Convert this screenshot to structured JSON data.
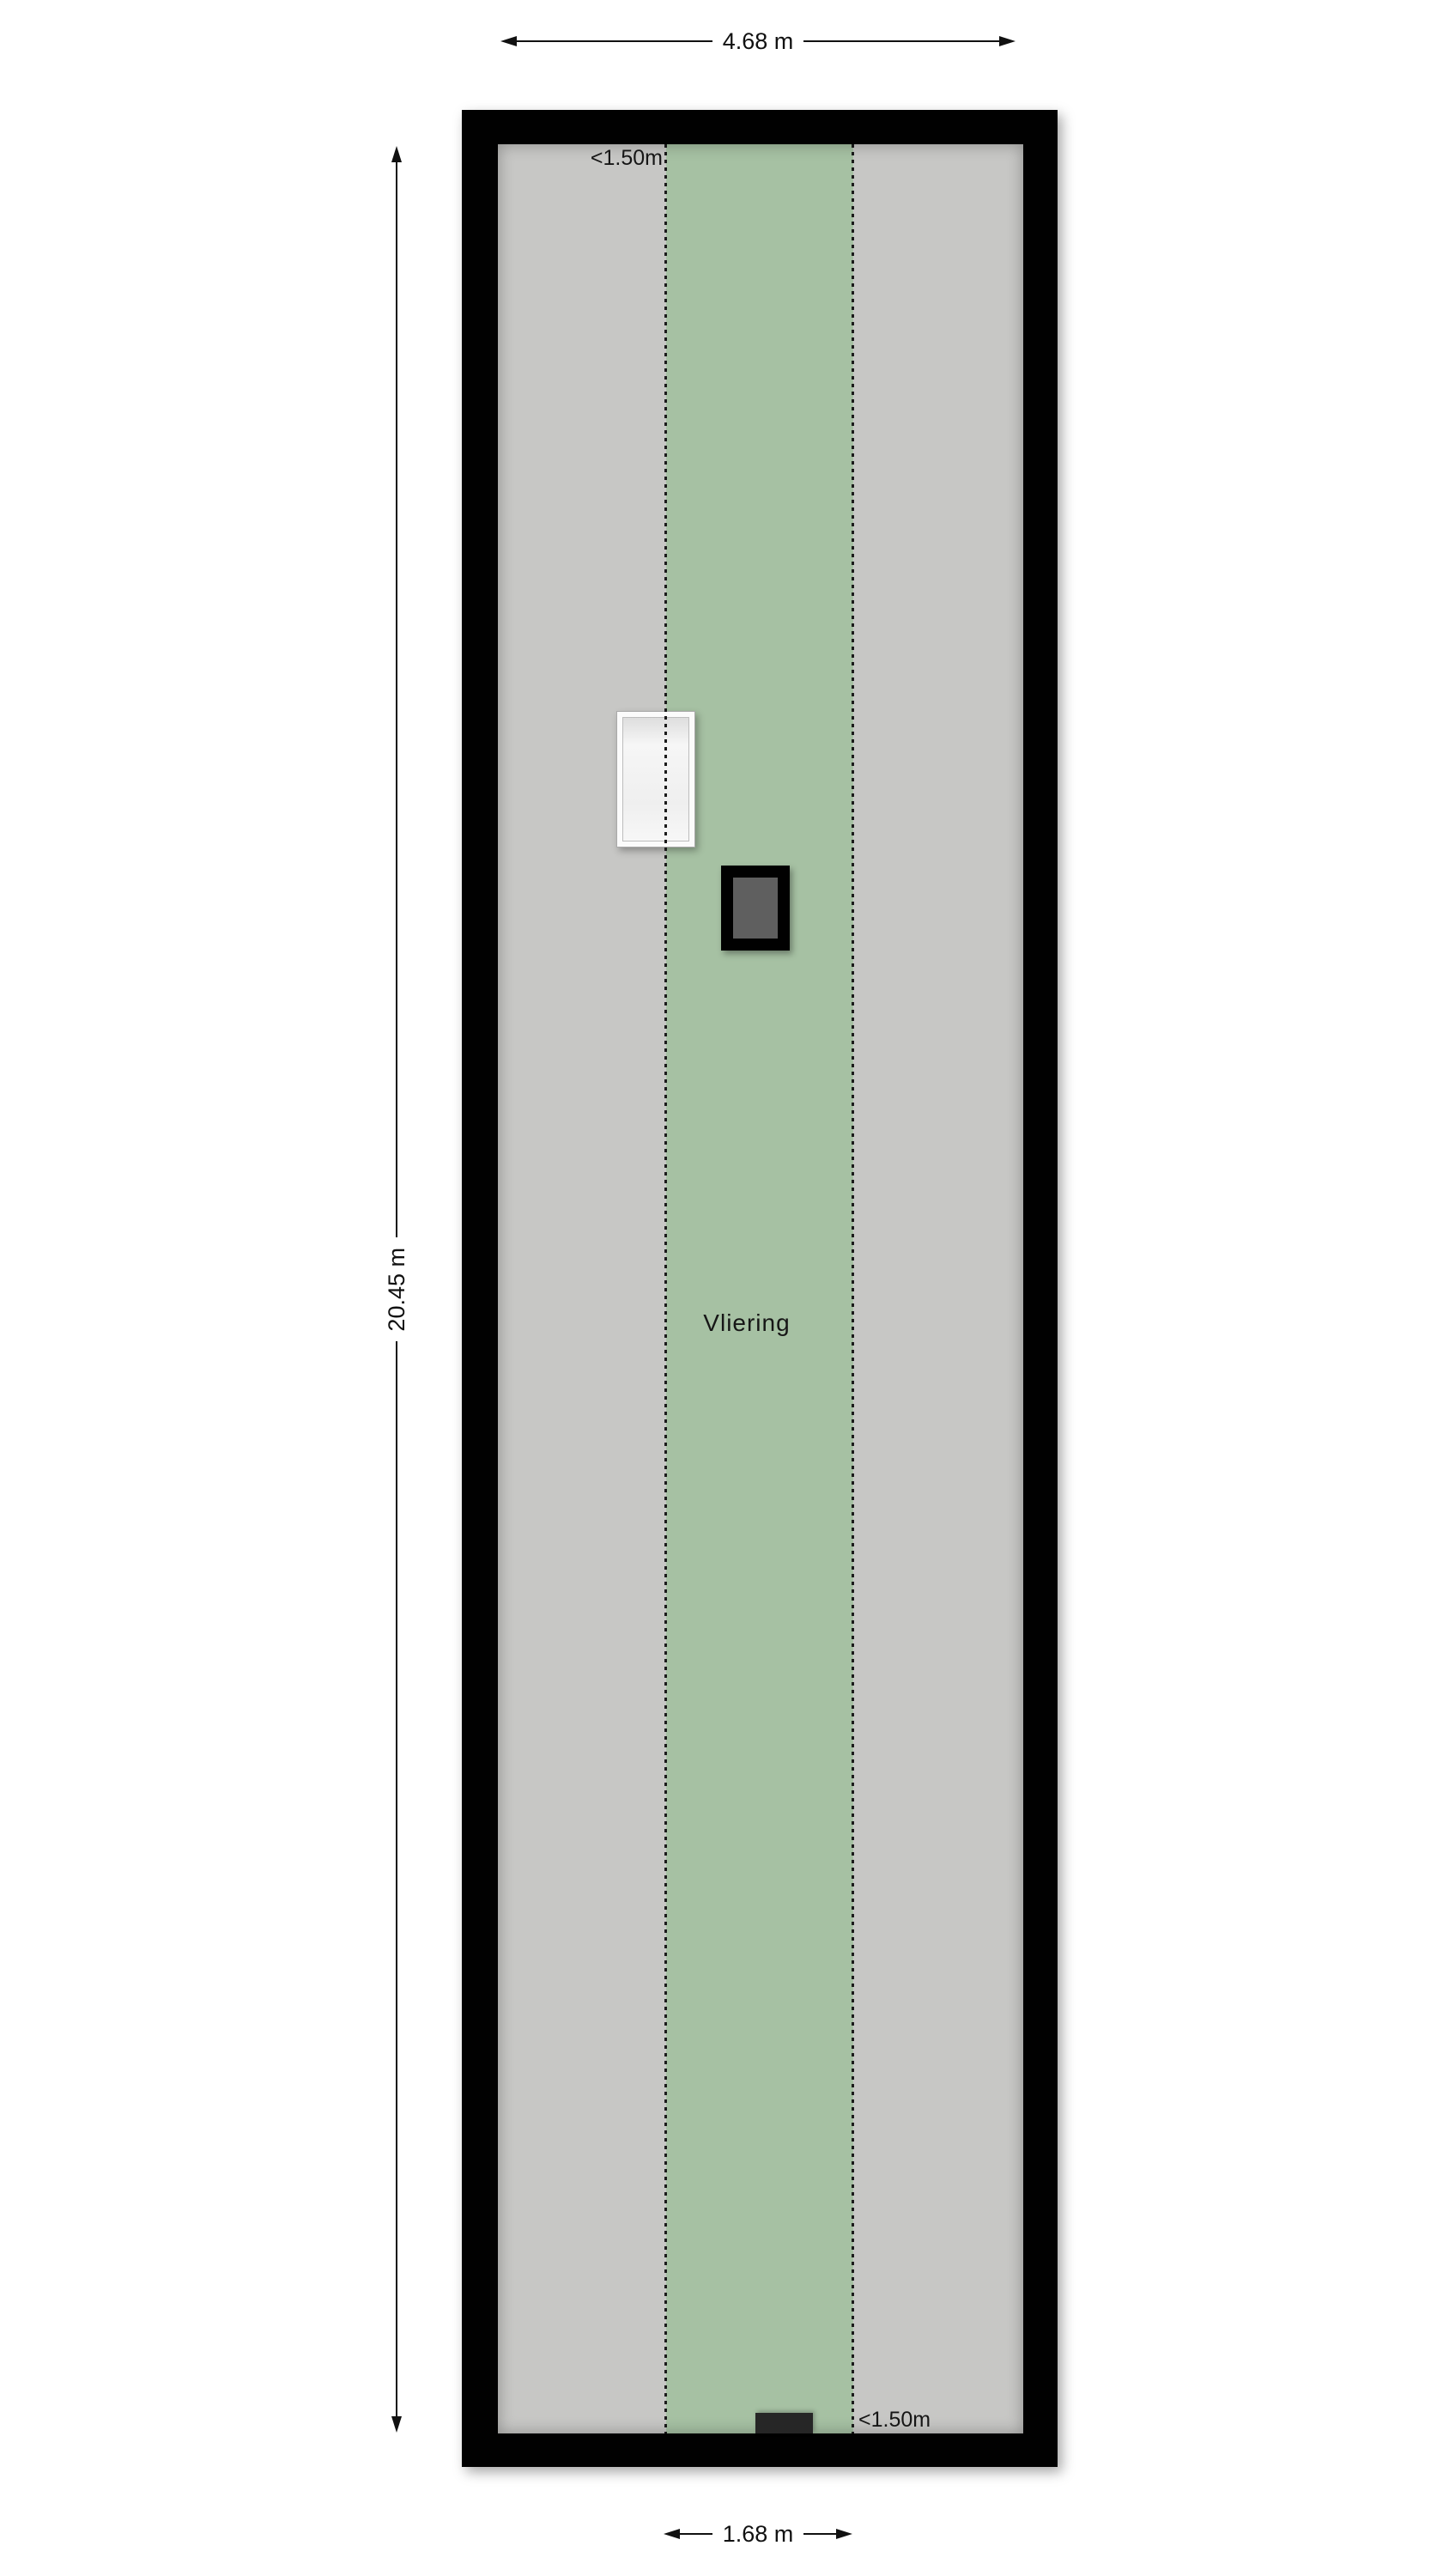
{
  "labels": {
    "room": "Vliering",
    "low_height_top": "<1.50m",
    "low_height_bottom": "<1.50m"
  },
  "dimensions": {
    "width": "4.68 m",
    "height": "20.45 m",
    "zone_width": "1.68 m"
  },
  "colors": {
    "wall": "#010101",
    "floor": "#c7c7c5",
    "zone": "#a6c1a3",
    "dotted": "#1b1b1b",
    "chimney_core": "#5f5f5f",
    "hatch": "#262626",
    "text": "#161616"
  }
}
